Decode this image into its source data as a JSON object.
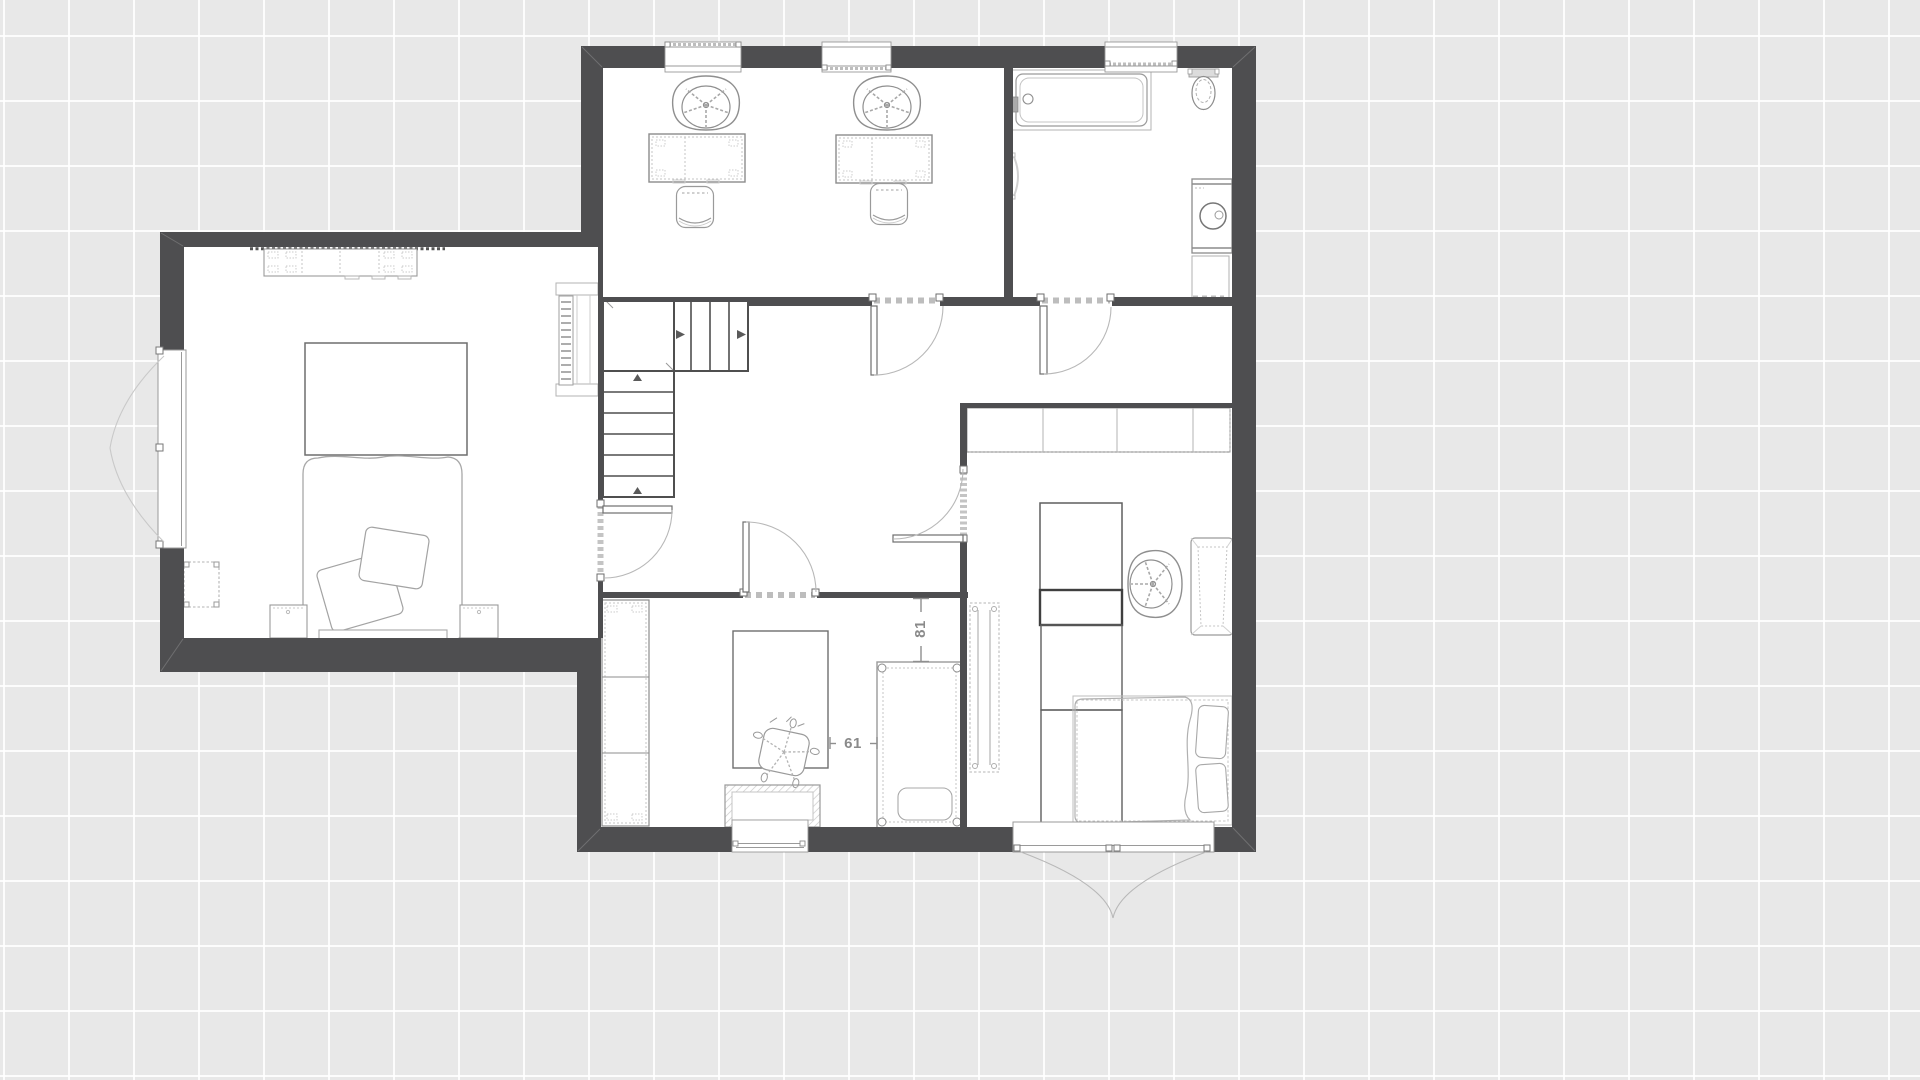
{
  "canvas": {
    "background_color": "#e8e8e8",
    "grid_line_color": "#ffffff",
    "grid_spacing_px": 65,
    "wall_color": "#4e4e50",
    "floor_color": "#ffffff",
    "furniture_line_color": "#9a9a9a",
    "dimension_color": "#8a8a8a"
  },
  "dimensions": {
    "crib_to_wall_vertical": {
      "value": "81",
      "orientation": "vertical"
    },
    "rug_to_crib_horizontal": {
      "value": "61",
      "orientation": "horizontal"
    }
  }
}
